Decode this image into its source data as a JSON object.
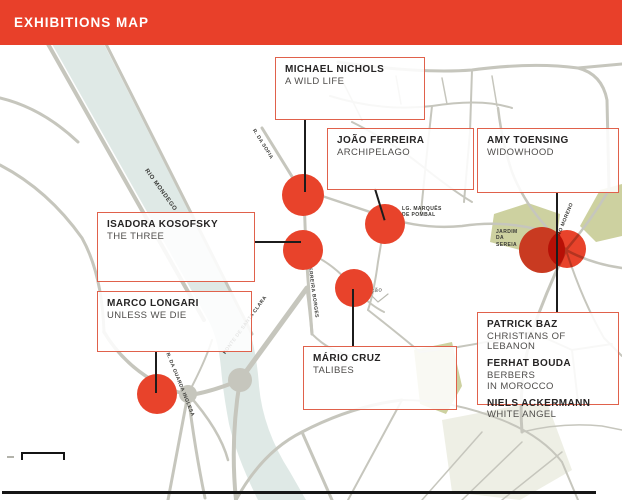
{
  "header": {
    "title": "EXHIBITIONS MAP"
  },
  "exhibitions": [
    {
      "id": "michael-nichols",
      "artist": "MICHAEL NICHOLS",
      "title": "A WILD LIFE"
    },
    {
      "id": "joao-ferreira",
      "artist": "JOÃO FERREIRA",
      "title": "ARCHIPELAGO"
    },
    {
      "id": "amy-toensing",
      "artist": "AMY TOENSING",
      "title": "WIDOWHOOD"
    },
    {
      "id": "isadora-kosofsky",
      "artist": "ISADORA KOSOFSKY",
      "title": "THE THREE"
    },
    {
      "id": "marco-longari",
      "artist": "MARCO LONGARI",
      "title": "UNLESS WE DIE"
    },
    {
      "id": "mario-cruz",
      "artist": "MÁRIO CRUZ",
      "title": "TALIBES"
    },
    {
      "id": "patrick-baz",
      "artist": "PATRICK BAZ",
      "title": "CHRISTIANS OF LEBANON"
    },
    {
      "id": "ferhat-bouda",
      "artist": "FERHAT BOUDA",
      "title": "BERBERS\nIN MOROCCO"
    },
    {
      "id": "niels-ackermann",
      "artist": "NIELS ACKERMANN",
      "title": "WHITE ANGEL"
    }
  ],
  "map": {
    "labels": [
      {
        "id": "rio-mondego",
        "text": "RIO MONDEGO"
      },
      {
        "id": "ponte-de-santa-clara",
        "text": "PONTE DE SANTA CLARA"
      },
      {
        "id": "r-da-sofia",
        "text": "R. DA SOFIA"
      },
      {
        "id": "r-ferreira-borges",
        "text": "R. FERREIRA BORGES"
      },
      {
        "id": "lg-marques-de-pombal",
        "text": "LG. MARQUÊS\nDE POMBAL"
      },
      {
        "id": "jardim-da-sereia",
        "text": "JARDIM\nDA\nSEREIA"
      },
      {
        "id": "r-da-guarda-inglesa",
        "text": "R. DA GUARDA INGLESA"
      },
      {
        "id": "r-pedro-moreno",
        "text": "R. PEDRO MORENO"
      },
      {
        "id": "estacao",
        "text": "estação"
      }
    ]
  },
  "colors": {
    "header_bg": "#e8402a",
    "marker": "#e8432b",
    "marker_dark": "#c93a21",
    "box_border": "#e0614b",
    "river": "#dfe9e6",
    "road": "#c6c6bd",
    "park": "#cdd1a0"
  }
}
